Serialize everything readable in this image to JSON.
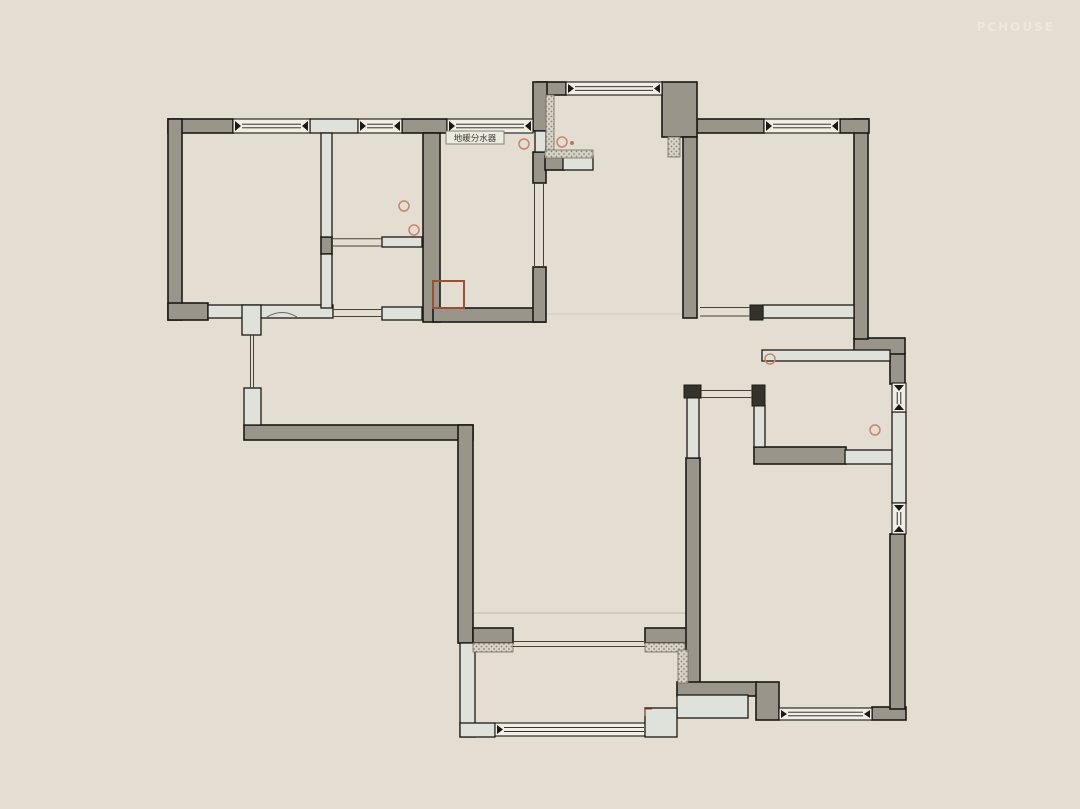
{
  "watermark": "PCHOUSE",
  "annotations": {
    "manifold_label": "地暖分水器"
  },
  "colors": {
    "background": "#e3ddd2",
    "wall_fill": "#99958a",
    "wall_outline": "#1c1914",
    "partition_fill": "#dfe2db",
    "window_fill": "#f1eee6",
    "stub_fill": "#35322b",
    "marker_stroke": "#c5866c",
    "flue_stroke": "#9a4f38",
    "label_text": "#3a372f",
    "watermark_color": "#f4f1e8"
  },
  "label_box": {
    "x": 446,
    "y": 131,
    "w": 58,
    "h": 13,
    "text_x": 475,
    "text_y": 141
  },
  "flue_box": {
    "x": 433,
    "y": 281,
    "w": 31,
    "h": 27
  },
  "markers": {
    "circles": [
      {
        "x": 524,
        "y": 144
      },
      {
        "x": 562,
        "y": 142
      },
      {
        "x": 404,
        "y": 206
      },
      {
        "x": 414,
        "y": 230
      },
      {
        "x": 770,
        "y": 359
      },
      {
        "x": 875,
        "y": 430
      }
    ],
    "dot": {
      "x": 572,
      "y": 143
    }
  }
}
